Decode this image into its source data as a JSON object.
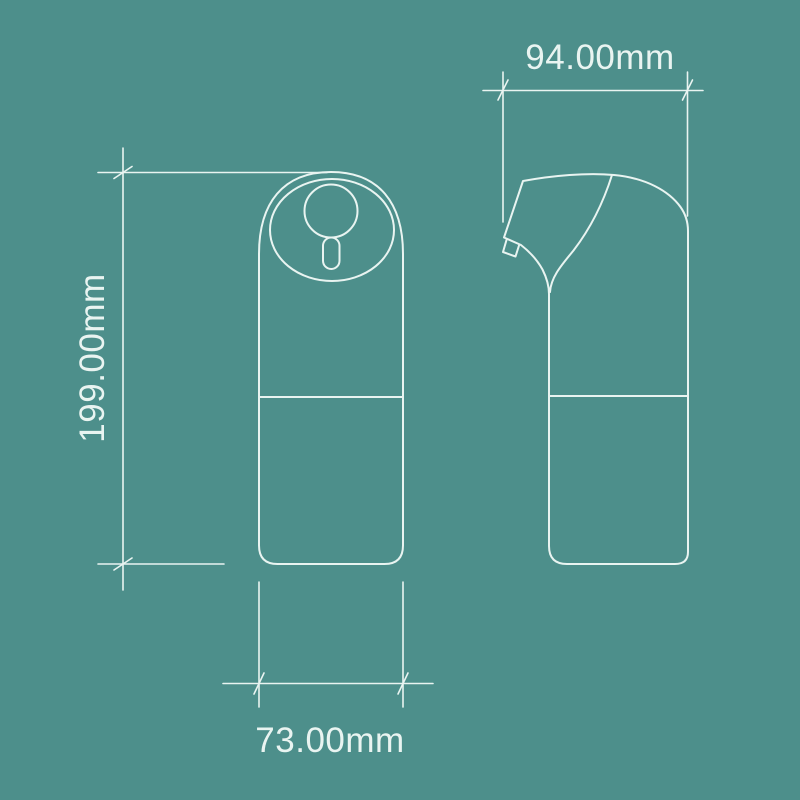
{
  "diagram": {
    "dimensions": {
      "height": {
        "label": "199.00mm",
        "value": 199.0,
        "unit": "mm"
      },
      "depth": {
        "label": "94.00mm",
        "value": 94.0,
        "unit": "mm"
      },
      "width": {
        "label": "73.00mm",
        "value": 73.0,
        "unit": "mm"
      }
    },
    "colors": {
      "background": "#4d8f8b",
      "line": "#e9f4f1",
      "text": "#e9f4f1"
    }
  }
}
